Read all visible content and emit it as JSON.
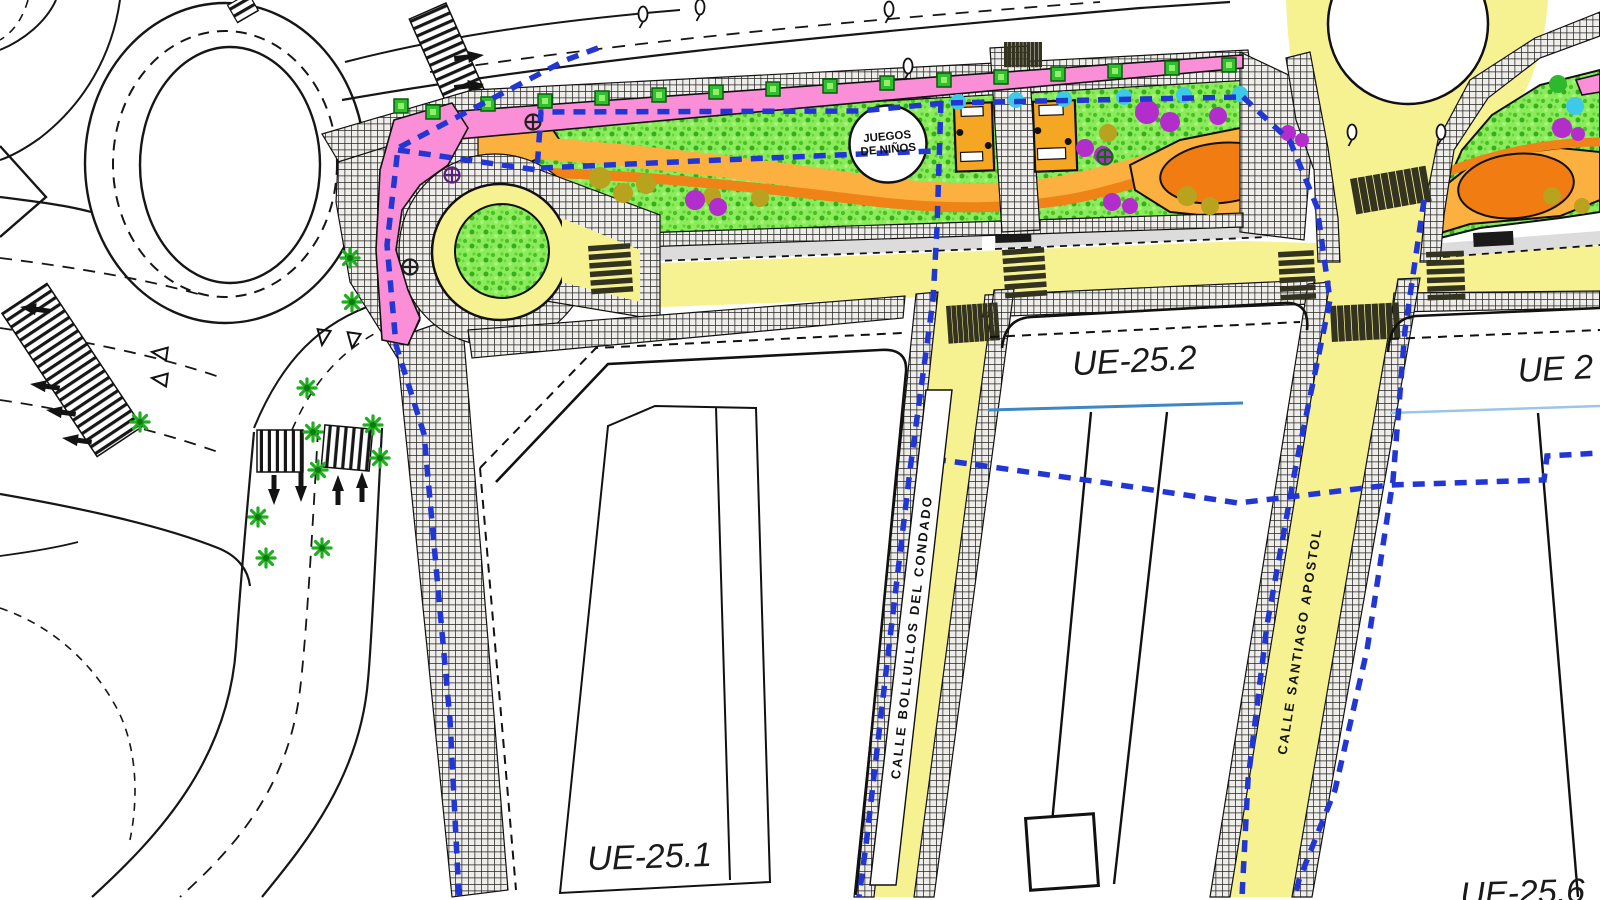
{
  "zones": {
    "ue_25_1": "UE-25.1",
    "ue_25_2": "UE-25.2",
    "ue_2": "UE 2",
    "ue_25_6": "UE-25.6"
  },
  "streets": {
    "bollullos": "CALLE BOLLULLOS DEL CONDADO",
    "santiago": "CALLE SANTIAGO APOSTOL"
  },
  "park": {
    "playground_line1": "JUEGOS",
    "playground_line2": "DE NIÑOS"
  },
  "colors": {
    "street_yellow": "#f6f292",
    "lawn_green": "#8ceb5a",
    "pink_paving": "#fa8fd8",
    "orange_path_light": "#fcb040",
    "orange_path_dark": "#ef8318",
    "orange_plaza": "#f07c12",
    "boundary_blue": "#2236d4",
    "utility_blue_line": "#3f86c4",
    "utility_lightblue_line": "#9cc6e4",
    "parking_gray": "#dcdcdc",
    "tree_green": "#1fae1f",
    "shrub_purple": "#b32ccc",
    "shrub_cyan": "#3ec9e8",
    "shrub_olive": "#b8a21e",
    "crosswalk_dark": "#33331f"
  },
  "symbols": {
    "tree": "green-asterisk-tree",
    "street_tree": "green-square-tree",
    "planting": "circle-cross-tree",
    "lamp": "lamp-post",
    "playground_area": "children-playground-circle"
  }
}
